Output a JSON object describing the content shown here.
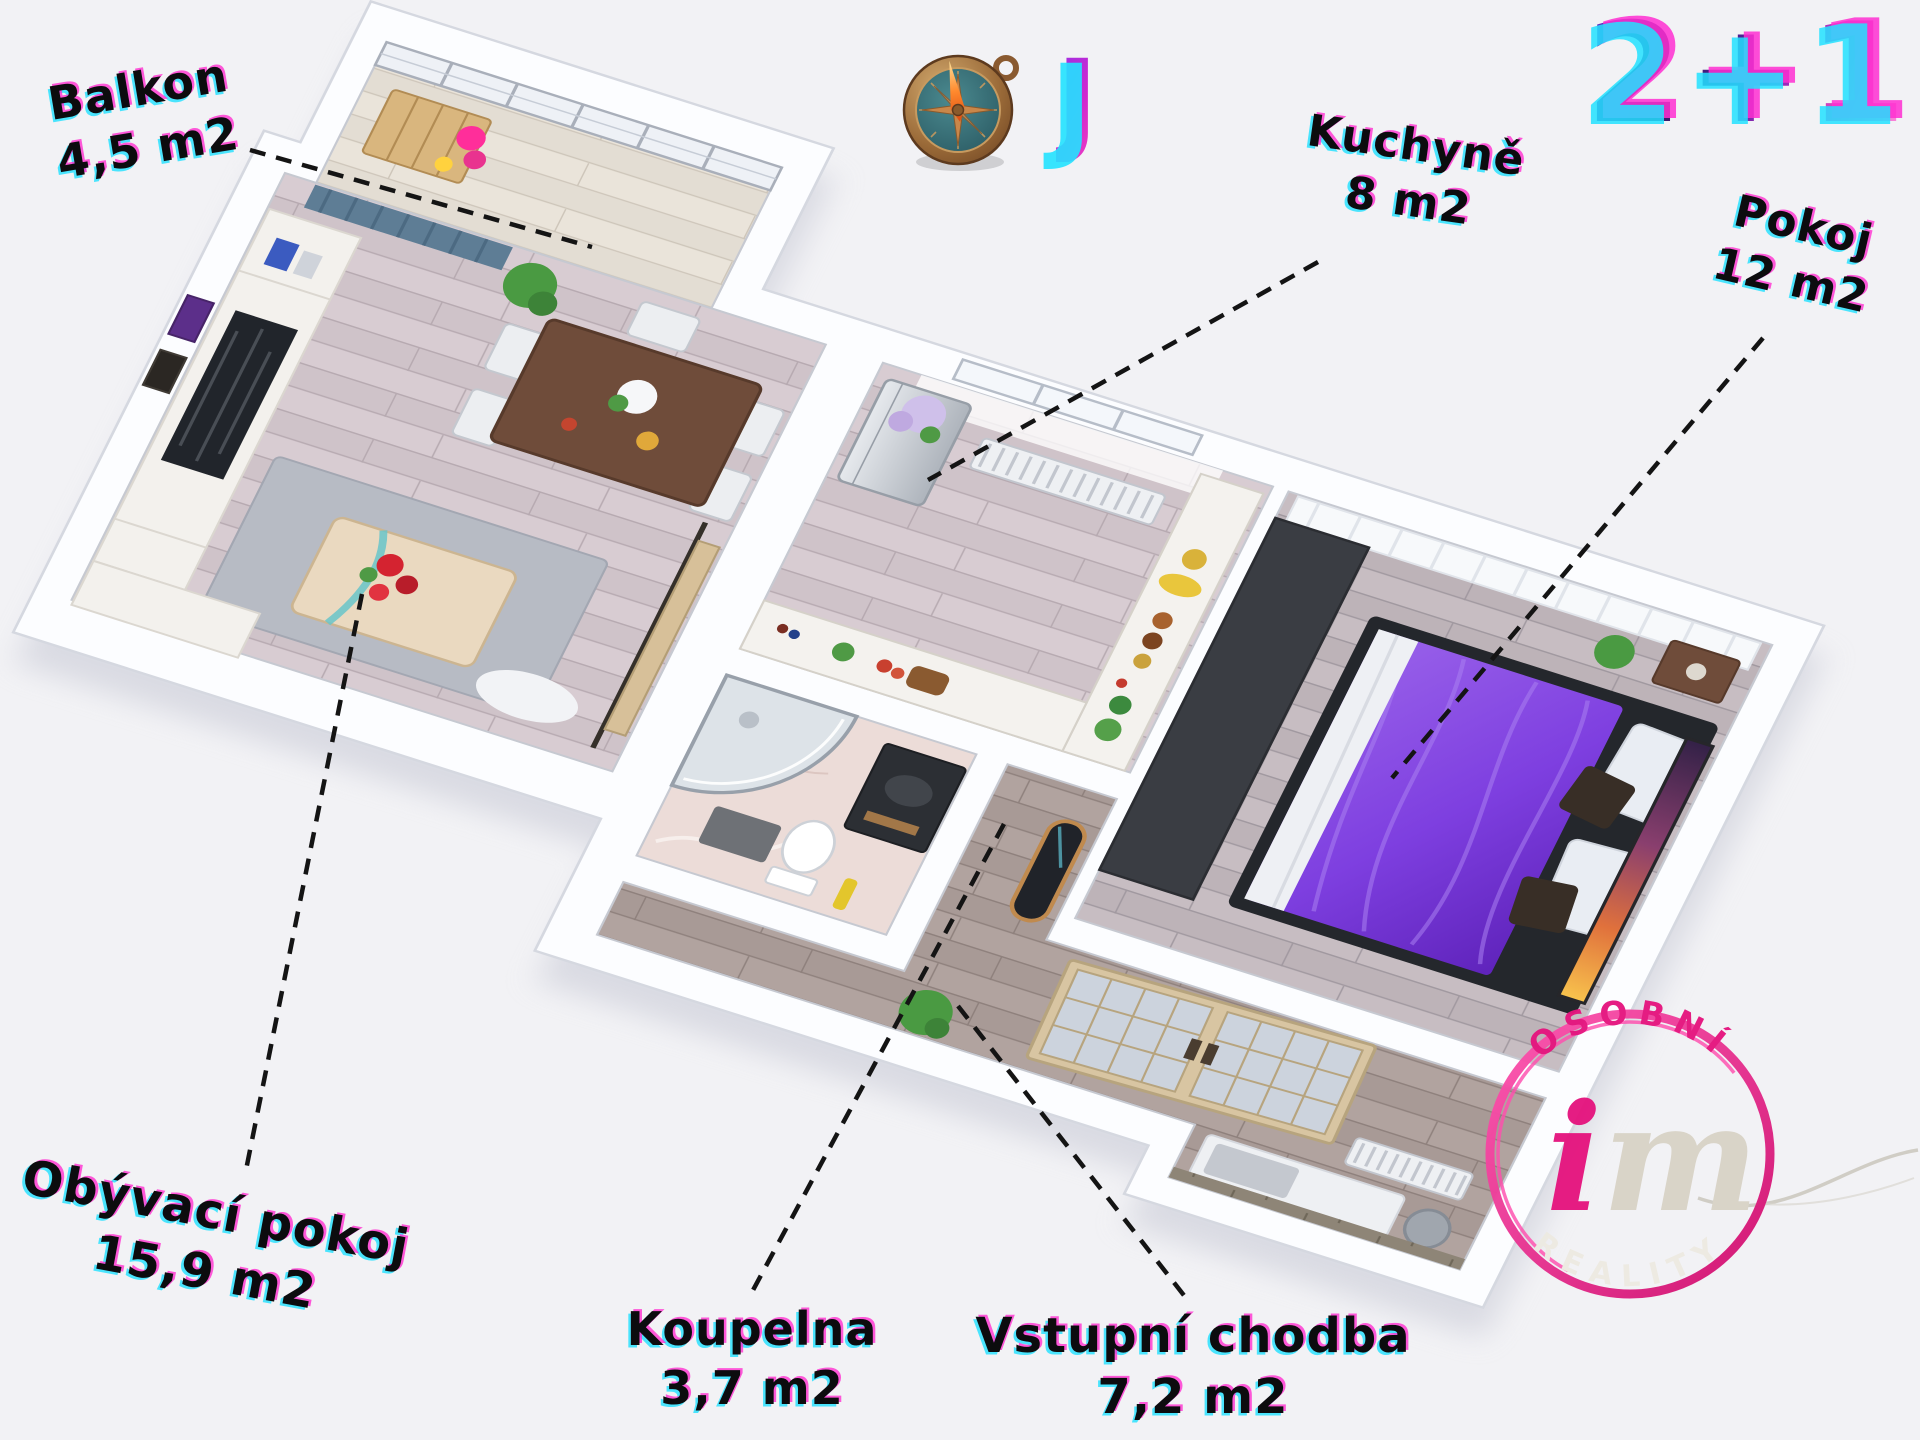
{
  "plan": {
    "type": "2+1"
  },
  "compass": {
    "direction": "J"
  },
  "rooms": {
    "balkon": {
      "label": "Balkon",
      "area": "4,5 m2"
    },
    "kuchyne": {
      "label": "Kuchyně",
      "area": "8 m2"
    },
    "pokoj": {
      "label": "Pokoj",
      "area": "12 m2"
    },
    "obyvaci_pokoj": {
      "label": "Obývací pokoj",
      "area": "15,9 m2"
    },
    "koupelna": {
      "label": "Koupelna",
      "area": "3,7 m2"
    },
    "vstupni_chodba": {
      "label": "Vstupní chodba",
      "area": "7,2 m2"
    }
  },
  "logo": {
    "arc_top": "OSOBNÍ",
    "monogram_i": "i",
    "monogram_m": "m",
    "arc_bottom": "REALITY"
  },
  "colors": {
    "accent_pink": "#e5147e",
    "label_ink": "#0c0c0e",
    "fringe_cyan": "#1fe0ff",
    "fringe_magenta": "#ff2fd1",
    "bed_purple": "#7e3fe0",
    "background": "#f2f2f5"
  }
}
